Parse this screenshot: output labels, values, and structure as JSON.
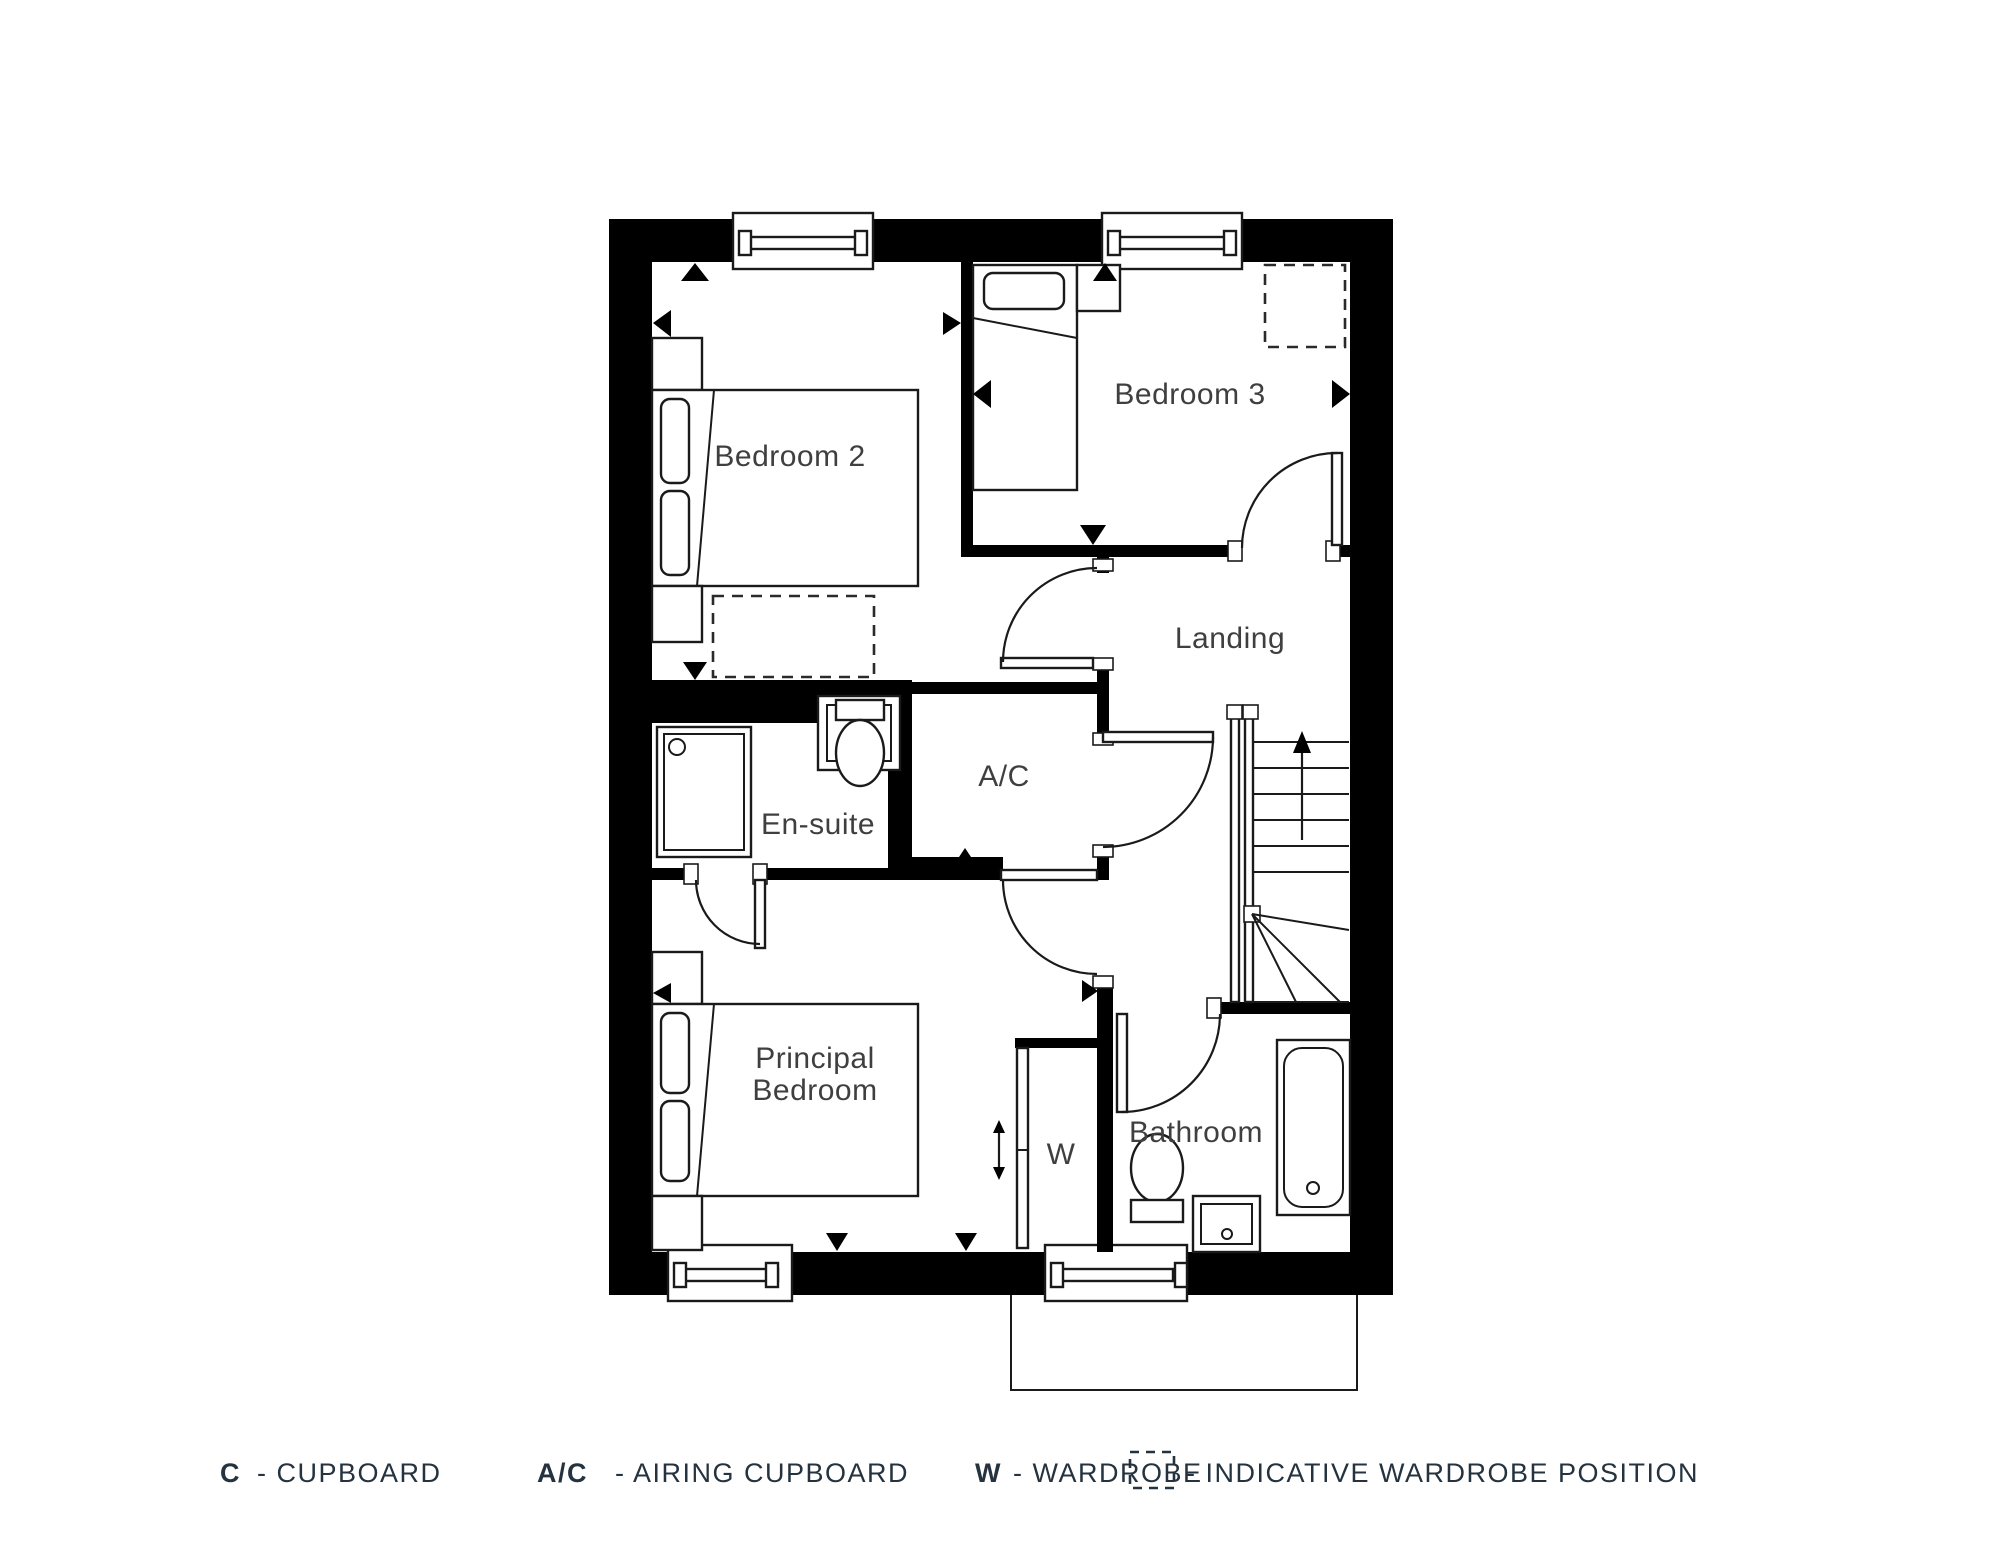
{
  "colors": {
    "wall": "#000000",
    "fixture_line": "#1a1a1a",
    "room_label": "#3f3f3f",
    "legend_text": "#24333f",
    "background": "#ffffff"
  },
  "floorplan": {
    "rooms": {
      "bedroom2": "Bedroom 2",
      "bedroom3": "Bedroom 3",
      "landing": "Landing",
      "ensuite": "En-suite",
      "airing_cupboard": "A/C",
      "principal_bedroom_line1": "Principal",
      "principal_bedroom_line2": "Bedroom",
      "wardrobe": "W",
      "bathroom": "Bathroom"
    }
  },
  "legend": {
    "items": [
      {
        "key": "C",
        "label": "- CUPBOARD"
      },
      {
        "key": "A/C",
        "label": "- AIRING CUPBOARD"
      },
      {
        "key": "W",
        "label": "- WARDROBE"
      },
      {
        "key": "",
        "label": "- INDICATIVE WARDROBE POSITION"
      }
    ]
  }
}
